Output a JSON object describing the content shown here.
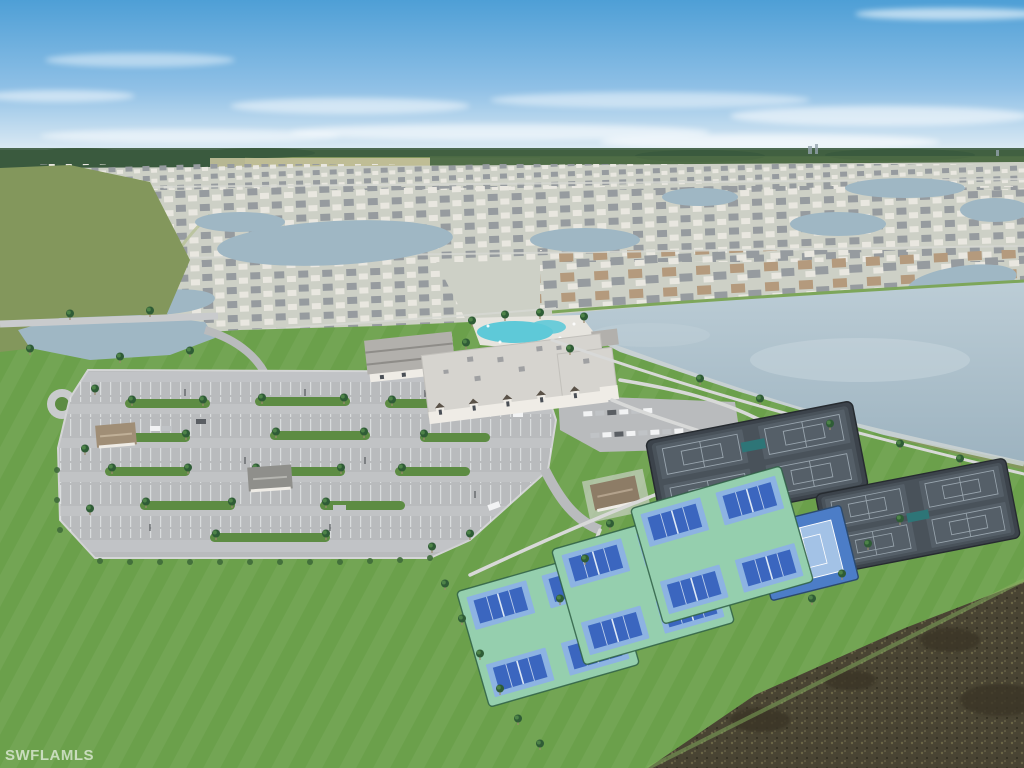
{
  "watermark": {
    "text": "SWFLAMLS"
  },
  "colors": {
    "sky_top": "#4e9fd6",
    "sky_mid": "#8fc0e6",
    "sky_horizon": "#e8f1f6",
    "cloud": "#ffffff",
    "treeline": "#3a5a3e",
    "forest_mid": "#4c6a44",
    "far_field": "#83975c",
    "marsh": "#c5c19b",
    "resi_ground": "#cdd0c6",
    "resi_street": "#d6d8d2",
    "roof_gray": "#969b9f",
    "roof_white": "#e9e7e0",
    "roof_tan": "#b49a7d",
    "lake": "#9fb7c4",
    "lake_big_top": "#bccdd6",
    "lake_big_bottom": "#9db3c0",
    "shore_rock": "#cdd3d4",
    "lawn": "#6ba04b",
    "lawn_light": "#7db35a",
    "lawn_dark": "#5c8f3f",
    "asphalt": "#b9bbbd",
    "asphalt_light": "#c9cbcd",
    "stripe": "#e9ebec",
    "island_green": "#5d8c43",
    "shrub": "#3f6b3a",
    "palm": "#2f5c36",
    "palm_light": "#4e8348",
    "trunk": "#9b8a6d",
    "path": "#d8d9d8",
    "roof_club": "#d6d4cf",
    "wall_club": "#efece6",
    "wall_shadow": "#8a8885",
    "window_dark": "#4a4f56",
    "roof_left_bldg": "#b2b0ac",
    "pool": "#5ec9d8",
    "pool_deck": "#e6e4de",
    "pavilion_roof_brown": "#8d7c66",
    "pavilion_roof_tan": "#a08e76",
    "pavilion_roof_gray": "#8f8f8b",
    "court_dark": "#49525a",
    "court_dark_inner": "#555f68",
    "court_dark_line": "#99a5ae",
    "court_apron": "#3c434b",
    "canopy_teal": "#2e7577",
    "pb_ground": "#95cfae",
    "pb_court_outer": "#8db3e2",
    "pb_court_inner": "#3b66bf",
    "pb_line": "#dde8f5",
    "fence": "#2f5f45",
    "tennis_blue_outer": "#4c7dc7",
    "tennis_blue_inner": "#a3c2e6",
    "scrub": "#494433",
    "scrub_light": "#6b6647",
    "scrub_dark": "#3a3626",
    "car_white": "#f2f3f4",
    "car_silver": "#c0c3c6",
    "car_dark": "#5a5e63",
    "watermark_color": "rgba(255,255,255,0.62)"
  }
}
